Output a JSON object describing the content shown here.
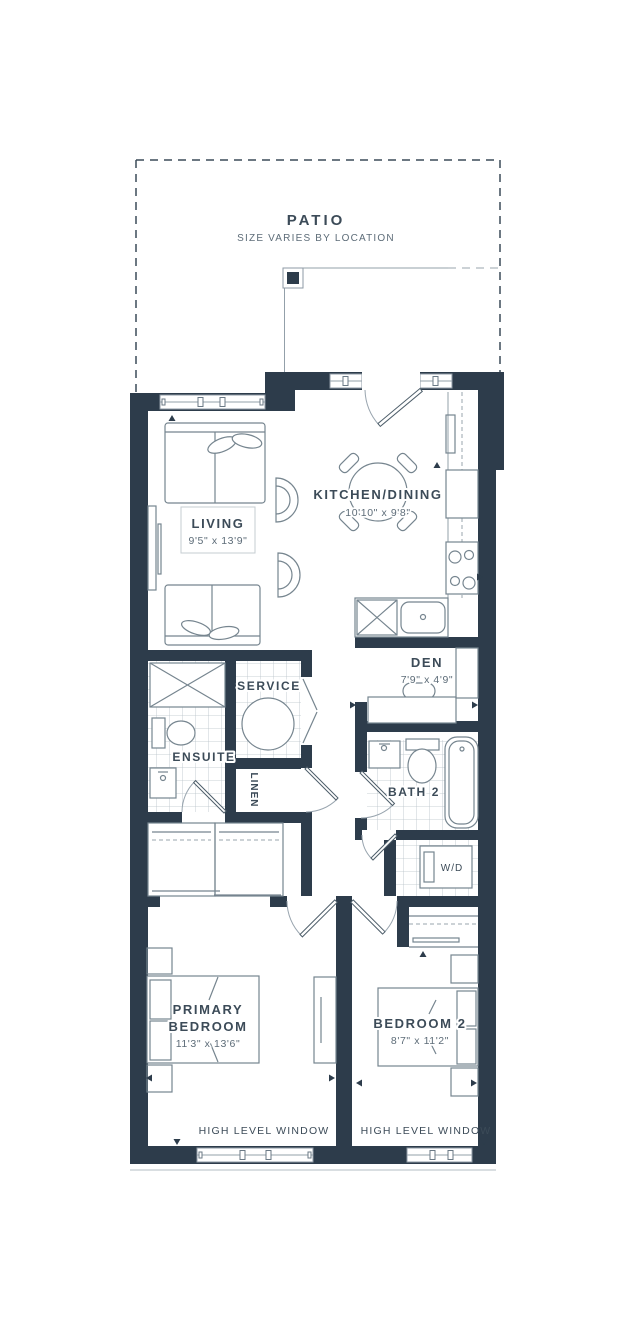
{
  "palette": {
    "wall": "#2d3c4b",
    "text": "#3c4b58",
    "line": "#76858f",
    "dim_text": "#5d6c78"
  },
  "rooms": {
    "patio": {
      "label": "PATIO",
      "note": "SIZE VARIES BY LOCATION"
    },
    "living": {
      "label": "LIVING",
      "dims": "9'5\" x 13'9\""
    },
    "kitchen_dining": {
      "label": "KITCHEN/DINING",
      "dims": "10'10\" x 9'8\""
    },
    "den": {
      "label": "DEN",
      "dims": "7'9\" x 4'9\""
    },
    "ensuite": {
      "label": "ENSUITE"
    },
    "service": {
      "label": "SERVICE"
    },
    "linen": {
      "label": "LINEN"
    },
    "bath2": {
      "label": "BATH 2"
    },
    "laundry": {
      "label": "W/D"
    },
    "primary_bedroom": {
      "label_line1": "PRIMARY",
      "label_line2": "BEDROOM",
      "dims": "11'3\" x 13'6\""
    },
    "bedroom2": {
      "label": "BEDROOM 2",
      "dims": "8'7\" x 11'2\""
    }
  },
  "annotations": {
    "high_level_window_left": "HIGH LEVEL WINDOW",
    "high_level_window_right": "HIGH LEVEL WINDOW"
  }
}
